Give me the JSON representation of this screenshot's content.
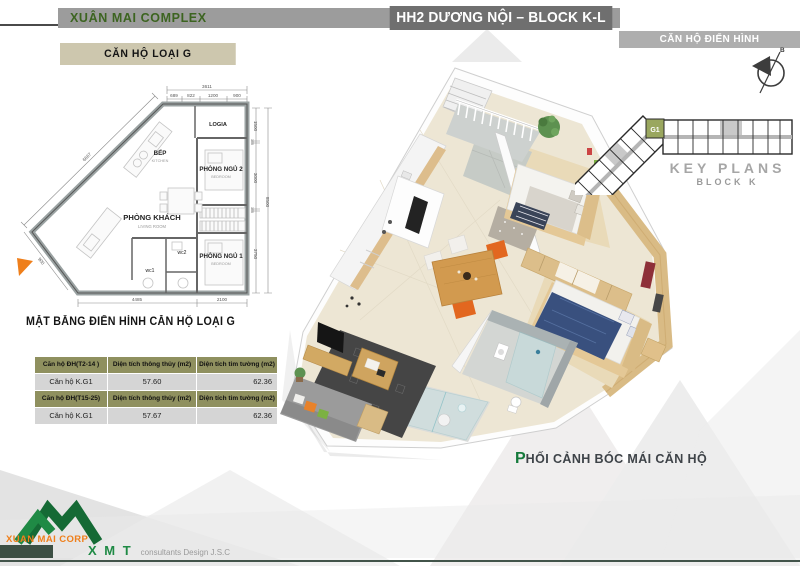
{
  "header": {
    "project_name": "XUÂN MAI COMPLEX",
    "block_title": "HH2 DƯƠNG NỘI – BLOCK K-L",
    "typical_unit_tag": "CĂN HỘ ĐIỂN HÌNH",
    "unit_type_tag": "CĂN HỘ LOẠI G"
  },
  "floor_plan": {
    "caption": "MẶT BẰNG ĐIỂN HÌNH CĂN HỘ LOẠI G",
    "rooms": {
      "logia": "LOGIA",
      "kitchen_vi": "BẾP",
      "kitchen_en": "KITCHEN",
      "bedroom2_vi": "PHÒNG NGỦ 2",
      "bedroom2_en": "BEDROOM",
      "living_vi": "PHÒNG KHÁCH",
      "living_en": "LIVING ROOM",
      "bedroom1_vi": "PHÒNG NGỦ 1",
      "bedroom1_en": "BEDROOM",
      "wc1": "wc1",
      "wc2": "wc2"
    },
    "dimensions": {
      "top_total": "3611",
      "top_segments": [
        "689",
        "822",
        "1200",
        "900"
      ],
      "right_segments": [
        "1500",
        "100",
        "3000",
        "100",
        "3750"
      ],
      "right_total": "8500",
      "bottom_segments": [
        "4485",
        "2100"
      ],
      "left_diagonal": "6667",
      "left_lower": "900"
    }
  },
  "area_table": {
    "rows": [
      {
        "c1": "Căn hộ ĐH(T2-14 )",
        "c2": "Diện tích thông thủy (m2)",
        "c3": "Diện tích tim tường (m2)"
      },
      {
        "c1": "Căn hộ K.G1",
        "c2": "57.60",
        "c3": "62.36"
      },
      {
        "c1": "Căn hộ ĐH(T15-25)",
        "c2": "Diện tích thông thủy (m2)",
        "c3": "Diện tích tim tường (m2)"
      },
      {
        "c1": "Căn hộ K.G1",
        "c2": "57.67",
        "c3": "62.36"
      }
    ]
  },
  "key_plan": {
    "title": "KEY PLANS",
    "subtitle": "BLOCK K",
    "highlight_unit": "G1",
    "compass_label": "B"
  },
  "perspective": {
    "caption_initial": "P",
    "caption_rest": "HỐI CẢNH BÓC MÁI CĂN HỘ"
  },
  "footer": {
    "corp_name": "XUAN MAI CORP",
    "designer": "X M T",
    "designer_suffix": "consultants Design J.S.C"
  },
  "colors": {
    "brand_green": "#1b7a3d",
    "accent_orange": "#ef7f1b",
    "olive_header": "#8f905f",
    "bar_gray": "#9c9c9c",
    "bar_dark": "#6f6f6f"
  }
}
